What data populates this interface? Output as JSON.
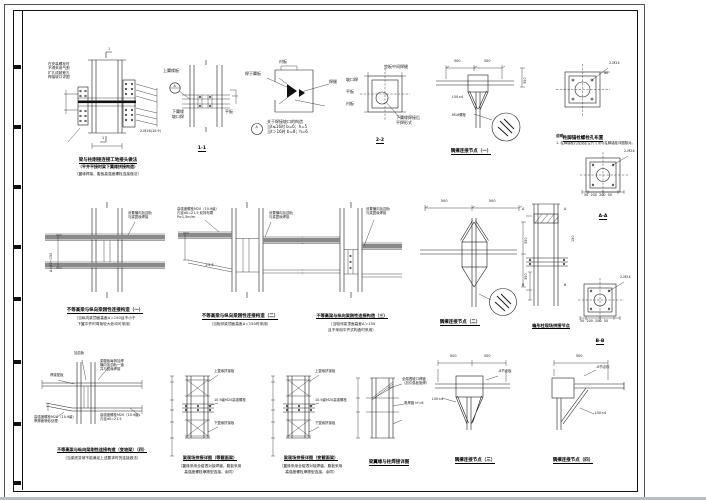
{
  "sheet": {
    "bottom_strip_color": "#b6bfc7",
    "line_color": "#1c1c1c"
  },
  "details": {
    "d1": {
      "note": "在安装螺栓时\n不得采用气割\n扩孔成超差孔\n焊接坡口详图",
      "bolt": "2-M16(10.9)",
      "mark_top": "1",
      "mark_bottom": "1",
      "cap1": "梁与柱刚接连接工地接头做法",
      "cap2": "（平齐平接时梁下翼缘拼接构造）",
      "cap3": "（翼缘焊接、腹板高强度螺栓连接做法）"
    },
    "d2": {
      "lbl_top": "上翼缘板",
      "lbl_a": "A",
      "lbl_bottom": "下翼缘\n坡口焊",
      "lbl_right": "平板",
      "cap": "1-1"
    },
    "d3": {
      "lbl_a": "A",
      "lbl_top": "衬板",
      "lbl_left": "焊于翼板",
      "lbl_right": "焊缝",
      "t": "关于焊接坡口的构造\n当t≤16时 b=6；h=5\n当t＞16时 b=8；h=6"
    },
    "d4": {
      "lbl_top": "垫板中间焊缝",
      "lbl_l1": "坡口焊",
      "lbl_l2": "平板",
      "lbl_l3": "衬板",
      "lbl_b": "下翼缘焊接后\n平焊形式",
      "cap": "2-2"
    },
    "d5": {
      "dim1": "500",
      "dim2": "500",
      "dim3": "350",
      "lbl1": "L50×4",
      "lbl2": "M16螺栓",
      "cap": "隅撑连接节点（一）"
    },
    "d6": {
      "lbl_bolt": "2-M24",
      "dim": "60",
      "cap": "柱脚锚栓螺栓孔布置",
      "note_head": "说明：",
      "note1": "1. 柱脚锚栓孔径及定位尺寸须与柱脚锚栓详图核对。"
    },
    "d7": {
      "lbl_bolt": "2-M24",
      "dims": "50  200  200  50",
      "cap": "A-A"
    },
    "d8": {
      "rot": "Δ=50～150",
      "an": "设置横向加劲肋\n与梁翼缘焊接",
      "cap": "不等高梁与纵向梁刚性连接构造（一）",
      "n1": "（当纵向梁顶面高差Δ＞150且不小于",
      "n2": "下翼平齐时弯矩较大处均可采用）"
    },
    "d9": {
      "a": "高强度螺栓M20（10.9级）\n孔径d0=21.5 双排布置\nP≥1.5m/m",
      "b": "设置横向加劲肋\n与梁翼缘焊接",
      "slope": "1:2.5",
      "cap": "不等高梁与纵向梁刚性连接构造（二）",
      "n1": "（当相邻梁顶面高差Δ＜150时采用）"
    },
    "d10": {
      "b": "设置横向加劲肋\n与梁翼缘焊接",
      "cap": "不等高梁与纵向梁刚性连接构造（三）",
      "n1": "（当相邻梁顶面高差Δ＞150",
      "n2": "且不采用平齐式构造时采用）"
    },
    "d11": {
      "dim1": "500",
      "dim2": "500",
      "dim3": "350",
      "dim4": "350",
      "cap": "隅撑连接节点（二）"
    },
    "d12": {
      "ma": "A",
      "mb": "B",
      "dim": "150",
      "cap": "箱形柱现场拼接节点"
    },
    "d13": {
      "lbl_bolt": "2-M24",
      "dims": "50  200  200  50",
      "cap": "B-B"
    },
    "d14": {
      "lbl_jin": "加劲肋",
      "a": "梁腹板每侧加焊\n横向加劲肋一道\n并与翼缘焊接",
      "lbl_dian": "焊接垫板",
      "bl": "高强度螺栓M20（10.9级）\n摩擦面喷砂处理",
      "br": "高强度螺栓M20（10.9级）\n孔径d0=21.5",
      "cap1": "不等高梁与纵向梁刚性连接构造（变坡梁）（四）",
      "cap2": "（当梁底变坡不能满足上述要求时的连接做法）"
    },
    "d15": {
      "r1": "上翼缘拼接板",
      "r2": "10.9级M20高强螺栓",
      "r3": "下翼缘拼接板",
      "cap1": "梁现场拼接详图（等截面梁）",
      "cap2": "（翼缘采用全熔透对接焊缝，腹板采用",
      "cap3": "高强度螺栓摩擦型连接，余同）"
    },
    "d16": {
      "r1": "上翼缘拼接板",
      "r2": "10.9级M20高强螺栓",
      "r3": "下翼缘拼接板",
      "cap1": "梁现场拼接详图（变截面梁）",
      "cap2": "（翼缘采用全熔透对接焊缝，腹板采用",
      "cap3": "高强度螺栓摩擦型连接，余同）"
    },
    "d17": {
      "r1": "全熔透坡口焊缝\n（加引弧板施焊）",
      "r2": "角焊缝 hf=6",
      "cap": "梁翼缘与柱焊接详图"
    },
    "d18": {
      "dim1": "500",
      "dim2": "500",
      "l1": "L50×4",
      "l2": "-8节点板",
      "cap": "隅撑连接节点（三）"
    },
    "d19": {
      "dim1": "500",
      "l1": "L50×4",
      "l2": "-8节点板",
      "cap": "隅撑连接节点（四）"
    }
  }
}
